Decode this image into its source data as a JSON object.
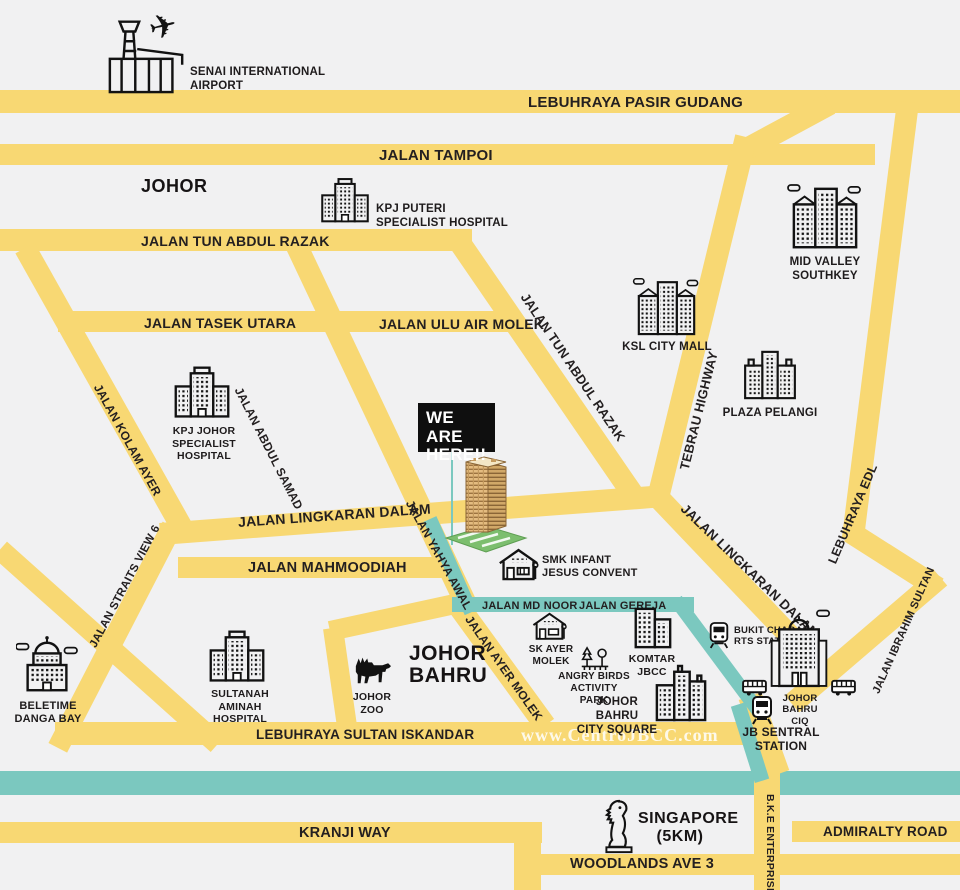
{
  "colors": {
    "background": "#F1F1F2",
    "road_yellow": "#F8D873",
    "route_teal": "#7BC8BF",
    "ink": "#231F20",
    "marker_bg": "#0F0F0F",
    "marker_text": "#FFFFFF",
    "watermark": "#FFFFFF",
    "tower_body": "#E4BC80",
    "tower_base": "#7CBE6E"
  },
  "marker": {
    "lines": [
      "WE ARE",
      "HERE!!"
    ]
  },
  "watermark_text": "www.CentroJBCC.com",
  "regions": {
    "state": "JOHOR",
    "city_lines": [
      "JOHOR",
      "BAHRU"
    ],
    "singapore_lines": [
      "SINGAPORE",
      "(5KM)"
    ]
  },
  "roads": {
    "pasir_gudang": "LEBUHRAYA PASIR GUDANG",
    "tampoi": "JALAN TAMPOI",
    "tun_abdul_razak": "JALAN TUN ABDUL RAZAK",
    "tasek_utara": "JALAN TASEK UTARA",
    "ulu_air_molek": "JALAN ULU AIR MOLEK",
    "kolam_ayer": "JALAN KOLAM AYER",
    "abdul_samad": "JALAN ABDUL SAMAD",
    "yahya_awal": "JALAN YAHYA AWAL",
    "lingkaran_dalam": "JALAN LINGKARAN DALAM",
    "mahmoodiah": "JALAN MAHMOODIAH",
    "straits_view": "JALAN STRAITS VIEW 6",
    "tebrau": "TEBRAU HIGHWAY",
    "edl": "LEBUHRAYA EDL",
    "ibrahim_sultan": "JALAN IBRAHIM SULTAN",
    "ayer_molek": "JALAN AYER MOLEK",
    "md_noor": "JALAN MD NOOR",
    "gereja": "JALAN GEREJA",
    "sultan_iskandar": "LEBUHRAYA SULTAN ISKANDAR",
    "kranji": "KRANJI WAY",
    "woodlands": "WOODLANDS AVE 3",
    "admiralty": "ADMIRALTY ROAD",
    "bke": "B.K.E ENTERPRISE"
  },
  "landmarks": {
    "senai": {
      "icon": "airport-icon",
      "lines": [
        "SENAI INTERNATIONAL",
        "AIRPORT"
      ]
    },
    "kpj_puteri": {
      "icon": "hospital-icon",
      "lines": [
        "KPJ PUTERI",
        "SPECIALIST HOSPITAL"
      ]
    },
    "mid_valley": {
      "icon": "mall-icon",
      "lines": [
        "MID VALLEY",
        "SOUTHKEY"
      ]
    },
    "ksl": {
      "icon": "mall-icon",
      "lines": [
        "KSL CITY MALL"
      ]
    },
    "plaza_pelangi": {
      "icon": "mall-icon",
      "lines": [
        "PLAZA PELANGI"
      ]
    },
    "kpj_johor": {
      "icon": "hospital-icon",
      "lines": [
        "KPJ JOHOR",
        "SPECIALIST HOSPITAL"
      ]
    },
    "beletime": {
      "icon": "dome-building-icon",
      "lines": [
        "BELETIME",
        "DANGA BAY"
      ]
    },
    "sultanah_aminah": {
      "icon": "hospital-icon",
      "lines": [
        "SULTANAH AMINAH",
        "HOSPITAL"
      ]
    },
    "johor_zoo": {
      "icon": "moose-icon",
      "lines": [
        "JOHOR",
        "ZOO"
      ]
    },
    "smk_ijc": {
      "icon": "school-icon",
      "lines": [
        "SMK INFANT",
        "JESUS CONVENT"
      ]
    },
    "sk_ayer_molek": {
      "icon": "school-icon",
      "lines": [
        "SK AYER",
        "MOLEK"
      ]
    },
    "angry_birds": {
      "icon": "park-trees-icon",
      "lines": [
        "ANGRY BIRDS",
        "ACTIVITY PARK"
      ]
    },
    "komtar": {
      "icon": "tower-block-icon",
      "lines": [
        "KOMTAR",
        "JBCC"
      ]
    },
    "city_square": {
      "icon": "mall-icon",
      "lines": [
        "JOHOR BAHRU",
        "CITY SQUARE"
      ]
    },
    "bukit_chagar": {
      "icon": "train-icon",
      "lines": [
        "BUKIT CHAGAR",
        "RTS STATION"
      ]
    },
    "ciq": {
      "icon": "customs-building-icon",
      "lines": [
        "JOHOR BAHRU",
        "CIQ"
      ]
    },
    "jb_sentral": {
      "icon": "train-icon",
      "lines": [
        "JB SENTRAL",
        "STATION"
      ]
    }
  }
}
